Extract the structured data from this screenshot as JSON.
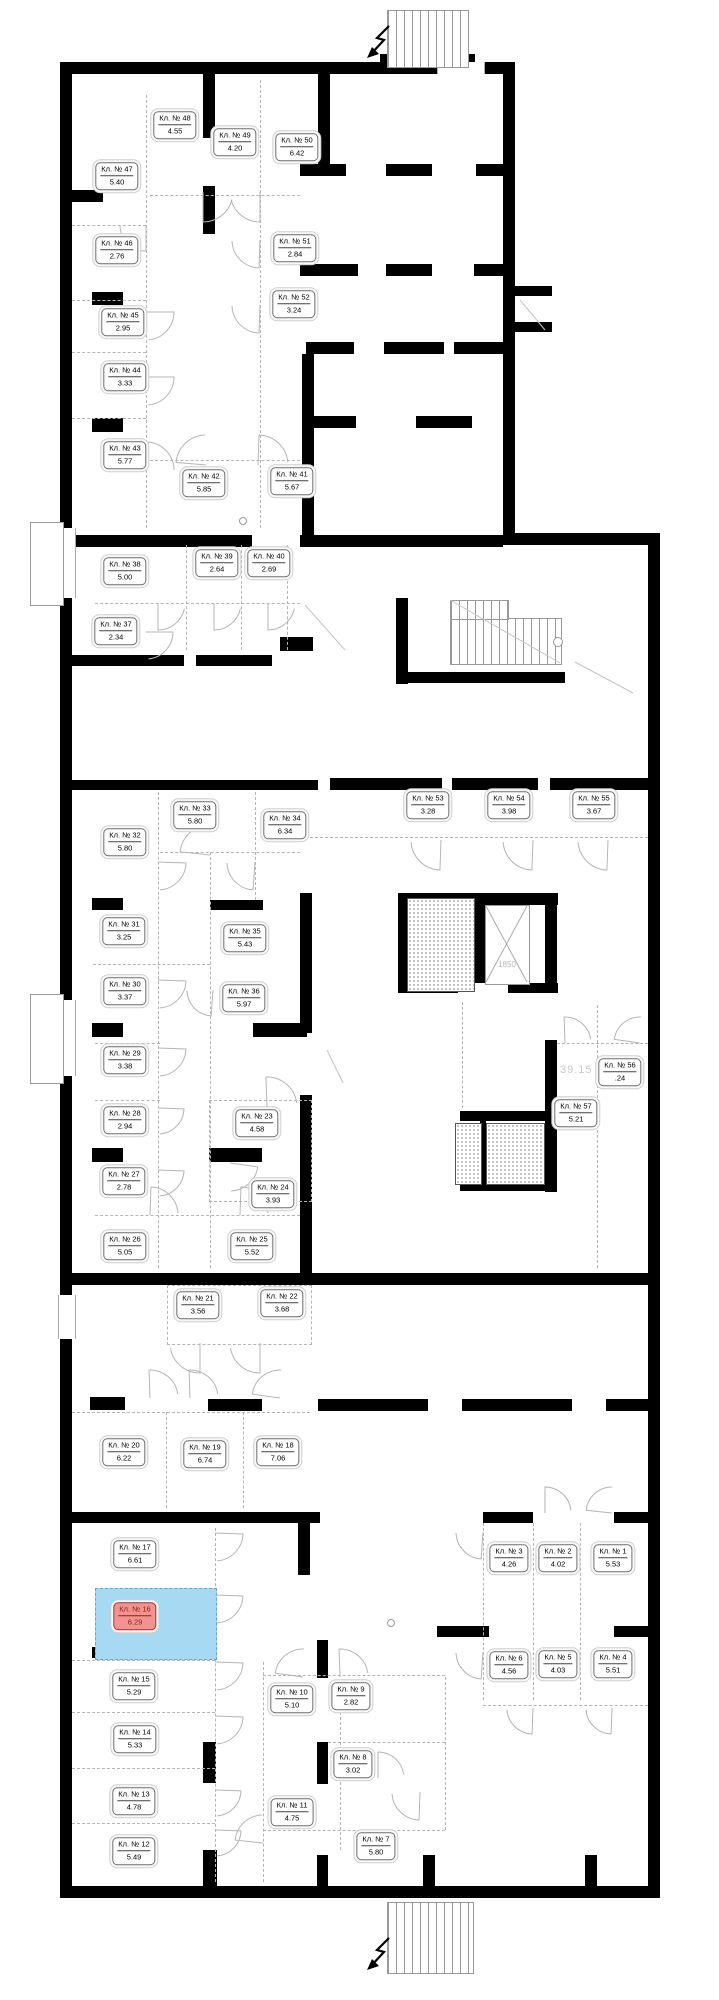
{
  "plan_name": "storage-units-floor-plan",
  "annotations": {
    "length_dimension": "39.15",
    "elevator_size": "1850"
  },
  "colors": {
    "highlight_fill": "#a7d9f2",
    "highlight_label_bg": "#f2938f",
    "highlight_label_text": "#87211d",
    "wall": "#000000"
  },
  "selected_room": {
    "label": "Кл. № 16",
    "area": "6.29"
  },
  "rooms": [
    {
      "id": 1,
      "label": "Кл. № 1",
      "area": "5.53",
      "highlighted": false
    },
    {
      "id": 2,
      "label": "Кл. № 2",
      "area": "4.02",
      "highlighted": false
    },
    {
      "id": 3,
      "label": "Кл. № 3",
      "area": "4.26",
      "highlighted": false
    },
    {
      "id": 4,
      "label": "Кл. № 4",
      "area": "5.51",
      "highlighted": false
    },
    {
      "id": 5,
      "label": "Кл. № 5",
      "area": "4.03",
      "highlighted": false
    },
    {
      "id": 6,
      "label": "Кл. № 6",
      "area": "4.56",
      "highlighted": false
    },
    {
      "id": 7,
      "label": "Кл. № 7",
      "area": "5.80",
      "highlighted": false
    },
    {
      "id": 8,
      "label": "Кл. № 8",
      "area": "3.02",
      "highlighted": false
    },
    {
      "id": 9,
      "label": "Кл. № 9",
      "area": "2.82",
      "highlighted": false
    },
    {
      "id": 10,
      "label": "Кл. № 10",
      "area": "5.10",
      "highlighted": false
    },
    {
      "id": 11,
      "label": "Кл. № 11",
      "area": "4.75",
      "highlighted": false
    },
    {
      "id": 12,
      "label": "Кл. № 12",
      "area": "5.49",
      "highlighted": false
    },
    {
      "id": 13,
      "label": "Кл. № 13",
      "area": "4.78",
      "highlighted": false
    },
    {
      "id": 14,
      "label": "Кл. № 14",
      "area": "5.33",
      "highlighted": false
    },
    {
      "id": 15,
      "label": "Кл. № 15",
      "area": "5.29",
      "highlighted": false
    },
    {
      "id": 16,
      "label": "Кл. № 16",
      "area": "6.29",
      "highlighted": true
    },
    {
      "id": 17,
      "label": "Кл. № 17",
      "area": "6.61",
      "highlighted": false
    },
    {
      "id": 18,
      "label": "Кл. № 18",
      "area": "7.06",
      "highlighted": false
    },
    {
      "id": 19,
      "label": "Кл. № 19",
      "area": "6.74",
      "highlighted": false
    },
    {
      "id": 20,
      "label": "Кл. № 20",
      "area": "6.22",
      "highlighted": false
    },
    {
      "id": 21,
      "label": "Кл. № 21",
      "area": "3.56",
      "highlighted": false
    },
    {
      "id": 22,
      "label": "Кл. № 22",
      "area": "3.68",
      "highlighted": false
    },
    {
      "id": 23,
      "label": "Кл. № 23",
      "area": "4.58",
      "highlighted": false
    },
    {
      "id": 24,
      "label": "Кл. № 24",
      "area": "3.93",
      "highlighted": false
    },
    {
      "id": 25,
      "label": "Кл. № 25",
      "area": "5.52",
      "highlighted": false
    },
    {
      "id": 26,
      "label": "Кл. № 26",
      "area": "5.05",
      "highlighted": false
    },
    {
      "id": 27,
      "label": "Кл. № 27",
      "area": "2.78",
      "highlighted": false
    },
    {
      "id": 28,
      "label": "Кл. № 28",
      "area": "2.94",
      "highlighted": false
    },
    {
      "id": 29,
      "label": "Кл. № 29",
      "area": "3.38",
      "highlighted": false
    },
    {
      "id": 30,
      "label": "Кл. № 30",
      "area": "3.37",
      "highlighted": false
    },
    {
      "id": 31,
      "label": "Кл. № 31",
      "area": "3.25",
      "highlighted": false
    },
    {
      "id": 32,
      "label": "Кл. № 32",
      "area": "5.80",
      "highlighted": false
    },
    {
      "id": 33,
      "label": "Кл. № 33",
      "area": "5.80",
      "highlighted": false
    },
    {
      "id": 34,
      "label": "Кл. № 34",
      "area": "6.34",
      "highlighted": false
    },
    {
      "id": 35,
      "label": "Кл. № 35",
      "area": "5.43",
      "highlighted": false
    },
    {
      "id": 36,
      "label": "Кл. № 36",
      "area": "5.97",
      "highlighted": false
    },
    {
      "id": 37,
      "label": "Кл. № 37",
      "area": "2.34",
      "highlighted": false
    },
    {
      "id": 38,
      "label": "Кл. № 38",
      "area": "5.00",
      "highlighted": false
    },
    {
      "id": 39,
      "label": "Кл. № 39",
      "area": "2.64",
      "highlighted": false
    },
    {
      "id": 40,
      "label": "Кл. № 40",
      "area": "2.69",
      "highlighted": false
    },
    {
      "id": 41,
      "label": "Кл. № 41",
      "area": "5.67",
      "highlighted": false
    },
    {
      "id": 42,
      "label": "Кл. № 42",
      "area": "5.85",
      "highlighted": false
    },
    {
      "id": 43,
      "label": "Кл. № 43",
      "area": "5.77",
      "highlighted": false
    },
    {
      "id": 44,
      "label": "Кл. № 44",
      "area": "3.33",
      "highlighted": false
    },
    {
      "id": 45,
      "label": "Кл. № 45",
      "area": "2.95",
      "highlighted": false
    },
    {
      "id": 46,
      "label": "Кл. № 46",
      "area": "2.76",
      "highlighted": false
    },
    {
      "id": 47,
      "label": "Кл. № 47",
      "area": "5.40",
      "highlighted": false
    },
    {
      "id": 48,
      "label": "Кл. № 48",
      "area": "4.55",
      "highlighted": false
    },
    {
      "id": 49,
      "label": "Кл. № 49",
      "area": "4.20",
      "highlighted": false
    },
    {
      "id": 50,
      "label": "Кл. № 50",
      "area": "6.42",
      "highlighted": false
    },
    {
      "id": 51,
      "label": "Кл. № 51",
      "area": "2.84",
      "highlighted": false
    },
    {
      "id": 52,
      "label": "Кл. № 52",
      "area": "3.24",
      "highlighted": false
    },
    {
      "id": 53,
      "label": "Кл. № 53",
      "area": "3.28",
      "highlighted": false
    },
    {
      "id": 54,
      "label": "Кл. № 54",
      "area": "3.98",
      "highlighted": false
    },
    {
      "id": 55,
      "label": "Кл. № 55",
      "area": "3.67",
      "highlighted": false
    },
    {
      "id": 56,
      "label": "Кл. № 56",
      "area": ".24",
      "highlighted": false
    },
    {
      "id": 57,
      "label": "Кл. № 57",
      "area": "5.21",
      "highlighted": false
    }
  ]
}
